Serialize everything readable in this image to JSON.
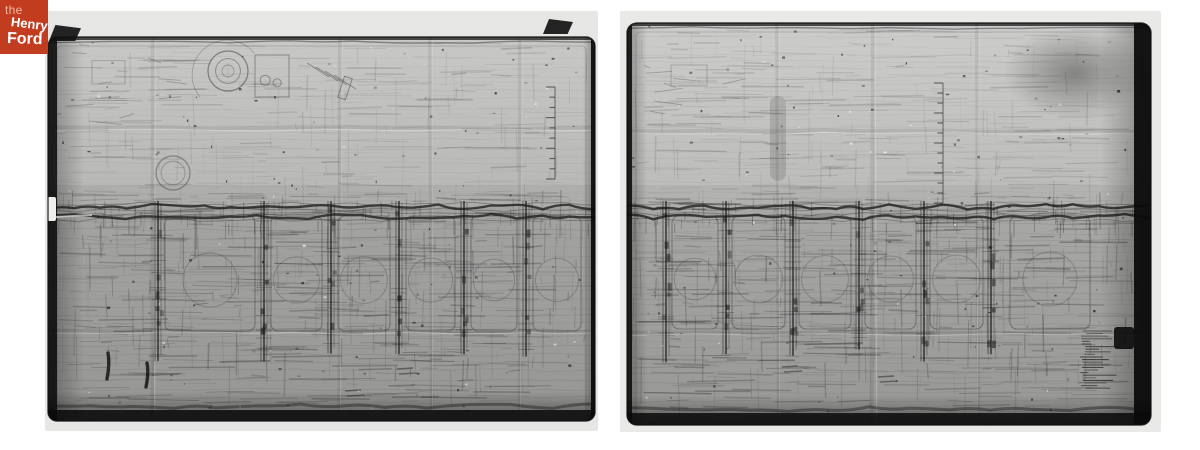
{
  "page": {
    "bg": "#ffffff"
  },
  "logo": {
    "line1": "the",
    "line2": "Henry",
    "line3": "Ford",
    "bg": "#c23d20",
    "line1_color": "#f3b8a2",
    "text_color": "#ffffff"
  },
  "panels": [
    {
      "name": "blueprint-photo-left",
      "x": 45,
      "y": 11,
      "w": 553,
      "h": 420,
      "seed": 7,
      "photo_bg": "#e6e6e4",
      "sheet": {
        "x": 3,
        "y": 26,
        "w": 547,
        "h": 384,
        "radius": 9,
        "top_color": "#c8c8c6",
        "mid_color": "#b7b7b5",
        "bottom_color": "#a8a8a6"
      },
      "edges": {
        "left": 9,
        "top": 3,
        "right": 4,
        "bottom": 11
      },
      "band": {
        "y": 196,
        "y2": 206
      },
      "bay_top": 202,
      "bay_bottom": 320,
      "columns": [
        112,
        218,
        285,
        353,
        418,
        480
      ],
      "bays": [
        {
          "x": 120,
          "w": 90
        },
        {
          "x": 226,
          "w": 51
        },
        {
          "x": 293,
          "w": 52
        },
        {
          "x": 361,
          "w": 49
        },
        {
          "x": 426,
          "w": 46
        },
        {
          "x": 488,
          "w": 48
        }
      ],
      "ruler": {
        "x": 510,
        "y1": 76,
        "y2": 168,
        "ticks": 10
      },
      "creases": {
        "vertical": [
          108,
          295,
          385,
          475
        ],
        "horizontal": [
          117,
          320
        ]
      },
      "notch": {
        "y": 186,
        "h": 24
      },
      "clips": [
        {
          "x": 4,
          "y": 14,
          "w": 32,
          "h": 16
        },
        {
          "x": 498,
          "y": 8,
          "w": 30,
          "h": 15
        }
      ],
      "tabs": [],
      "details": [
        {
          "type": "sketch",
          "x": 14,
          "y": 34,
          "w": 110,
          "h": 78
        },
        {
          "type": "gear",
          "cx": 183,
          "cy": 60,
          "r": 20
        },
        {
          "type": "box",
          "x": 210,
          "y": 44,
          "w": 34,
          "h": 42
        },
        {
          "type": "bracket",
          "x": 262,
          "y": 52
        },
        {
          "type": "circle2",
          "cx": 128,
          "cy": 162,
          "r": 17
        },
        {
          "type": "ink",
          "x": 63,
          "y": 342,
          "len": 26
        },
        {
          "type": "ink",
          "x": 102,
          "y": 352,
          "len": 24
        },
        {
          "type": "textmark",
          "x": 352,
          "y": 358
        },
        {
          "type": "textmark",
          "x": 300,
          "y": 380
        }
      ],
      "texture": {
        "h": 520,
        "v": 260,
        "specks": 150
      }
    },
    {
      "name": "blueprint-photo-right",
      "x": 620,
      "y": 11,
      "w": 541,
      "h": 421,
      "seed": 13,
      "photo_bg": "#e9e9e7",
      "sheet": {
        "x": 7,
        "y": 12,
        "w": 524,
        "h": 402,
        "radius": 10,
        "top_color": "#cccccb",
        "mid_color": "#bcbcba",
        "bottom_color": "#a9a9a7"
      },
      "edges": {
        "left": 5,
        "top": 3,
        "right": 17,
        "bottom": 12
      },
      "band": {
        "y": 196,
        "y2": 206
      },
      "bay_top": 202,
      "bay_bottom": 318,
      "columns": [
        45,
        105,
        172,
        238,
        303,
        370
      ],
      "bays": [
        {
          "x": 52,
          "w": 46
        },
        {
          "x": 112,
          "w": 53
        },
        {
          "x": 179,
          "w": 52
        },
        {
          "x": 245,
          "w": 51
        },
        {
          "x": 310,
          "w": 53
        },
        {
          "x": 390,
          "w": 80
        }
      ],
      "ruler": {
        "x": 323,
        "y1": 72,
        "y2": 192,
        "ticks": 13
      },
      "creases": {
        "vertical": [
          157,
          253,
          357
        ],
        "horizontal": [
          120,
          322
        ]
      },
      "notch": null,
      "clips": [],
      "tabs": [
        {
          "x": 494,
          "y": 316,
          "w": 20,
          "h": 22
        }
      ],
      "details": [
        {
          "type": "sketch",
          "x": 15,
          "y": 40,
          "w": 120,
          "h": 70
        },
        {
          "type": "vsmudge",
          "x": 150,
          "y": 85,
          "w": 16,
          "h": 85
        },
        {
          "type": "smudge",
          "cx": 455,
          "cy": 62,
          "rx": 72,
          "ry": 46
        },
        {
          "type": "notes",
          "x": 460,
          "y": 320,
          "w": 36,
          "h": 58
        },
        {
          "type": "textmark",
          "x": 162,
          "y": 356
        },
        {
          "type": "textmark",
          "x": 258,
          "y": 366
        }
      ],
      "texture": {
        "h": 540,
        "v": 270,
        "specks": 150
      }
    }
  ]
}
